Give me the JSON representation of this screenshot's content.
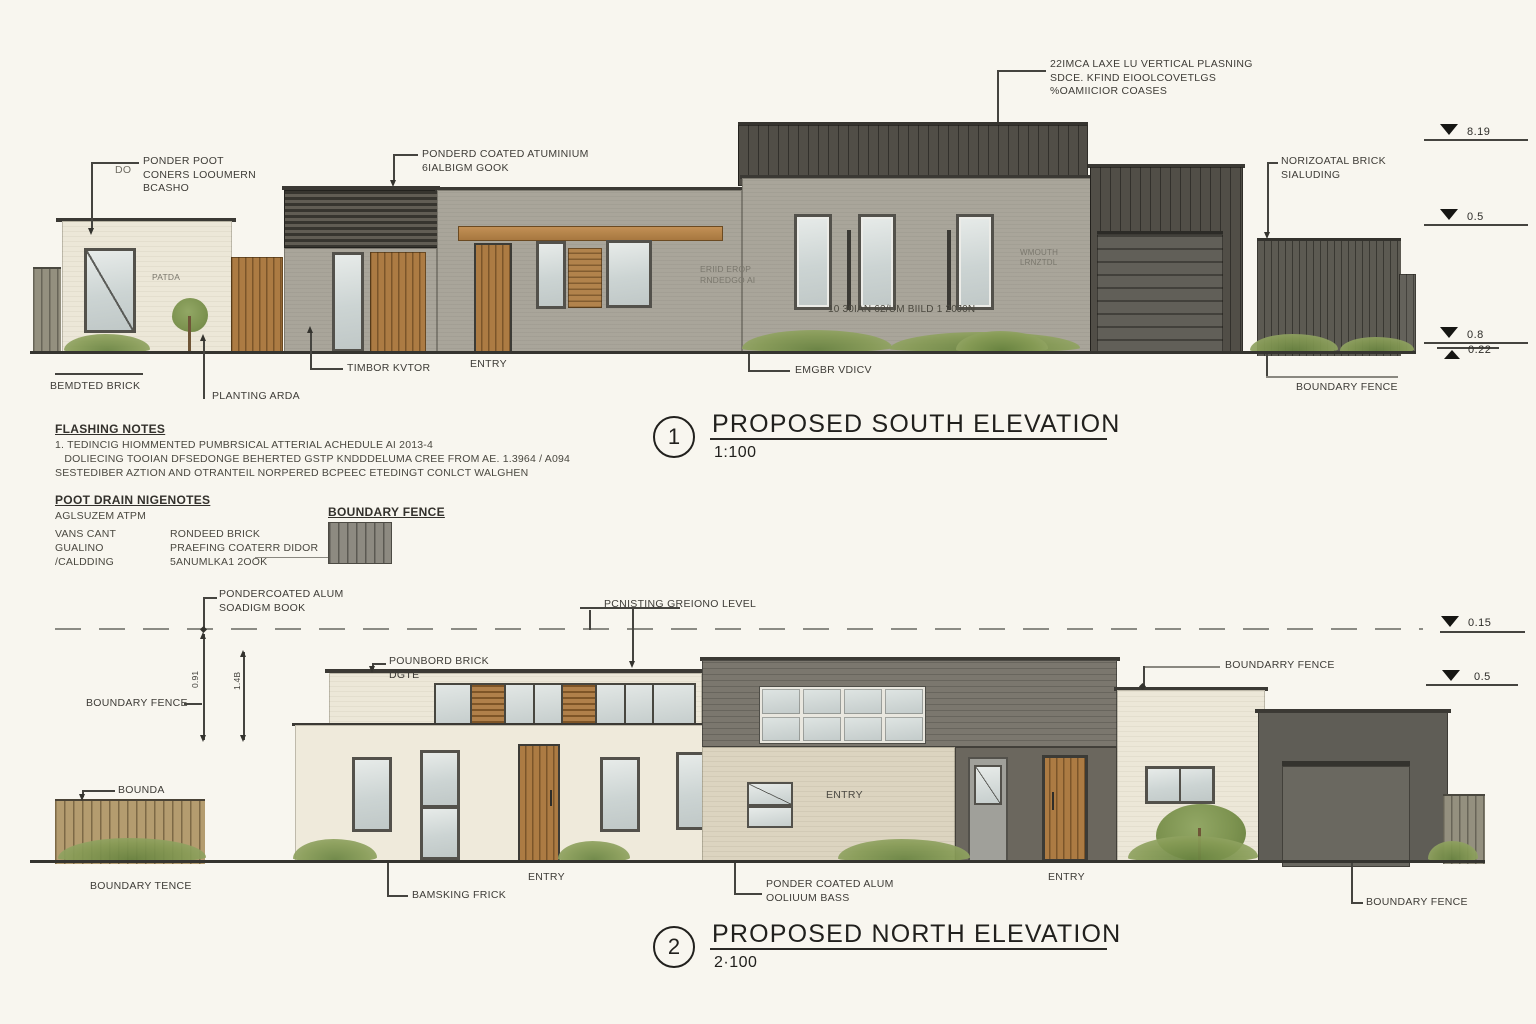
{
  "colors": {
    "paper": "#f8f6ef",
    "dark_cladding": "#514e47",
    "grey_wall": "#a9a59a",
    "cream_wall": "#ece7d8",
    "timber": "#ac7b43",
    "greenery": "#869b55"
  },
  "south": {
    "title": {
      "number": "1",
      "text": "PROPOSED SOUTH ELEVATION",
      "scale": "1:100"
    },
    "callouts": {
      "cladding_note": "22IMCA LAXE LU VERTICAL PLASNING\nSDCE. KFIND EIOOLCOVETLGS\n%OAMIICIOR COASES",
      "powder_post_prefix": "DO",
      "powder_post": "PONDER POOT\nCONERS LOOUMERN\nBCASHO",
      "powder_alum": "PONDERD COATED ATUMINIUM\n6IALBIGM GOOK",
      "horiz_brick": "NORIZOATAL BRICK\nSIALUDING",
      "patio": "PATDA",
      "roof_note": "ERIID EROP\nRNDEDGO AI",
      "wall_note": "10 30IAN 62/UM BIILD 1 20J0N",
      "window_note": "WMOUTH\nLRNZTDL",
      "bedded_brick": "BEMDTED BRICK",
      "planting": "PLANTING ARDA",
      "timber_door": "TIMBOR KVTOR",
      "entry": "ENTRY",
      "timber_note": "EMGBR VDICV",
      "boundary_fence": "BOUNDARY FENCE"
    },
    "levels": [
      {
        "value": "8.19"
      },
      {
        "value": "0.5"
      },
      {
        "value": "0.8"
      },
      {
        "value": "0.22"
      }
    ]
  },
  "notes": {
    "flashing_title": "FLASHING NOTES",
    "flashing_body": "1. TEDINCIG HIOMMENTED PUMBRSICAL ATTERIAL ACHEDULE AI 2013-4\n   DOLIECING TOOIAN DFSEDONGE BEHERTED GSTP KNDDDELUMA CREE FROM AE. 1.3964 / A094\nSESTEDIBER AZTION AND OTRANTEIL NORPERED BCPEEC ETEDINGT CONLCT WALGHEN",
    "roof_drain_title": "POOT DRAIN NIGENOTES",
    "roof_drain_sub": "AGLSUZEM  ATPM",
    "legend_col1": "VANS CANT\nGUALINO\n/CALDDING",
    "legend_col2": "RONDEED BRICK\nPRAEFING COATERR DIDOR\n5ANUMLKA1 2OOK",
    "legend_fence_title": "BOUNDARY FENCE"
  },
  "north": {
    "title": {
      "number": "2",
      "text": "PROPOSED NORTH ELEVATION",
      "scale": "2·100"
    },
    "callouts": {
      "powder_top": "PONDERCOATED ALUM\nSOADIGM BOOK",
      "existing_level": "PCNISTING GREIONO  LEVEL",
      "painted_brick": "POUNBORD BRICK\nDGTE",
      "boundary_left": "BOUNDARY FENCE",
      "bounda": "BOUNDA",
      "boundarry_right": "BOUNDARRY FENCE",
      "dim_a": "0.91",
      "dim_b": "1.4B",
      "entry_wall": "ENTRY",
      "boundary_bl": "BOUNDARY TENCE",
      "bamsking": "BAMSKING FRICK",
      "entry_mid": "ENTRY",
      "powder_bottom": "PONDER COATED ALUM\nOOLIUUM BASS",
      "entry_right": "ENTRY",
      "boundary_br": "BOUNDARY FENCE"
    },
    "levels": [
      {
        "value": "0.15"
      },
      {
        "value": "0.5"
      }
    ]
  }
}
